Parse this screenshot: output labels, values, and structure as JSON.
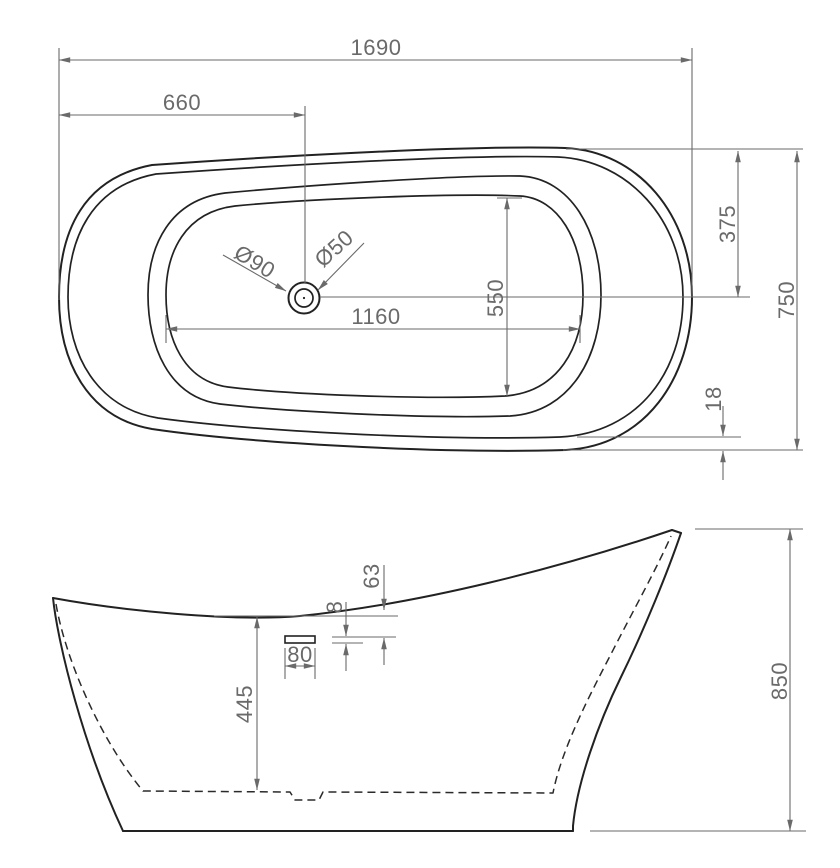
{
  "drawing": {
    "type": "bathtub-technical-drawing",
    "background_color": "#ffffff",
    "outline_color": "#222222",
    "dimension_color": "#6a6a6a",
    "top_view": {
      "overall_length": "1690",
      "drain_offset_from_left": "660",
      "overall_width": "750",
      "centerline_from_top": "375",
      "inner_length": "1160",
      "inner_width": "550",
      "rim_edge_gap": "18",
      "drain_outer_diameter": "Ø90",
      "drain_inner_diameter": "Ø50"
    },
    "side_view": {
      "overall_height": "850",
      "inner_depth": "445",
      "overflow_slot_length": "80",
      "overflow_slot_height": "8",
      "overflow_below_rim": "63"
    }
  }
}
